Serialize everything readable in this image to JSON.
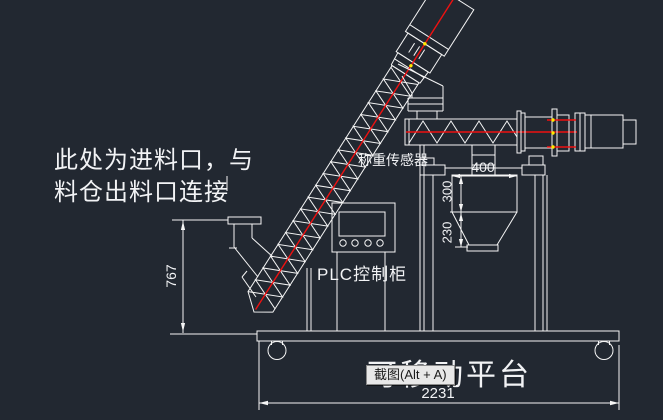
{
  "canvas": {
    "width": 663,
    "height": 420,
    "background": "#222831"
  },
  "labels": {
    "inlet_note_line1": "此处为进料口，与",
    "inlet_note_line2": "料仓出料口连接",
    "load_cell": "称重传感器",
    "plc": "PLC控制柜",
    "platform": "可移动平台"
  },
  "dimensions": {
    "hopper_width": "400",
    "hopper_body_height": "300",
    "hopper_cone_height": "230",
    "feeder_inlet_height": "767",
    "platform_length": "2231"
  },
  "tooltip": {
    "label": "截图(Alt + A)"
  },
  "colors": {
    "background": "#222831",
    "line": "#f5f5f5",
    "centerline_red": "#ee1111",
    "marker_yellow": "#ffe900",
    "tooltip_bg": "#e8e8e8",
    "tooltip_text": "#1a1a1a"
  }
}
